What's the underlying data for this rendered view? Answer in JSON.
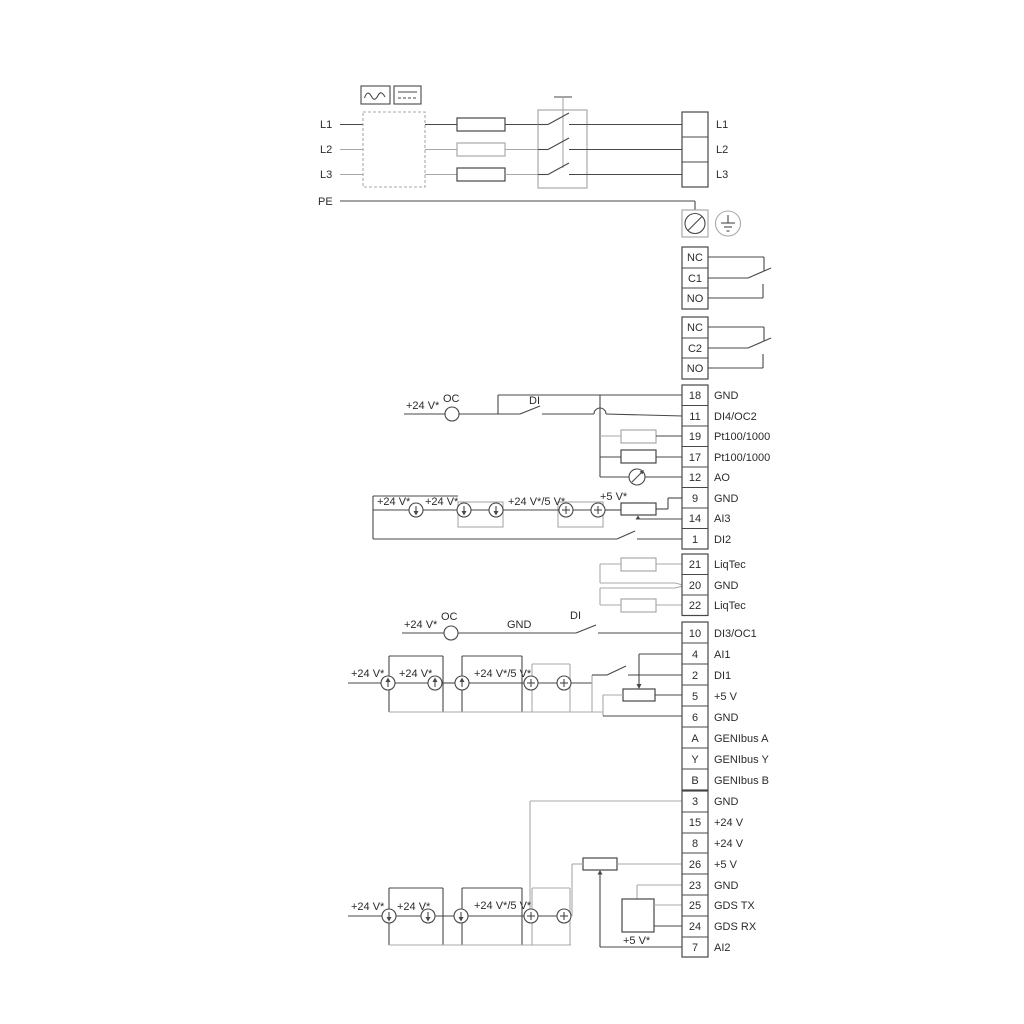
{
  "mains": {
    "input_labels": [
      "L1",
      "L2",
      "L3",
      "PE"
    ],
    "output_labels": [
      "L1",
      "L2",
      "L3"
    ]
  },
  "relay1": {
    "rows": [
      "NC",
      "C1",
      "NO"
    ]
  },
  "relay2": {
    "rows": [
      "NC",
      "C2",
      "NO"
    ]
  },
  "strip1": {
    "rows": [
      {
        "num": "18",
        "label": "GND"
      },
      {
        "num": "11",
        "label": "DI4/OC2"
      },
      {
        "num": "19",
        "label": "Pt100/1000"
      },
      {
        "num": "17",
        "label": "Pt100/1000"
      },
      {
        "num": "12",
        "label": "AO"
      },
      {
        "num": "9",
        "label": "GND"
      },
      {
        "num": "14",
        "label": "AI3"
      },
      {
        "num": "1",
        "label": "DI2"
      }
    ]
  },
  "strip2": {
    "rows": [
      {
        "num": "21",
        "label": "LiqTec"
      },
      {
        "num": "20",
        "label": "GND"
      },
      {
        "num": "22",
        "label": "LiqTec"
      }
    ]
  },
  "strip3": {
    "rows": [
      {
        "num": "10",
        "label": "DI3/OC1"
      },
      {
        "num": "4",
        "label": "AI1"
      },
      {
        "num": "2",
        "label": "DI1"
      },
      {
        "num": "5",
        "label": "+5 V"
      },
      {
        "num": "6",
        "label": "GND"
      },
      {
        "num": "A",
        "label": "GENIbus A"
      },
      {
        "num": "Y",
        "label": "GENIbus Y"
      },
      {
        "num": "B",
        "label": "GENIbus B"
      }
    ]
  },
  "strip4": {
    "rows": [
      {
        "num": "3",
        "label": "GND"
      },
      {
        "num": "15",
        "label": "+24 V"
      },
      {
        "num": "8",
        "label": "+24 V"
      },
      {
        "num": "26",
        "label": "+5 V"
      },
      {
        "num": "23",
        "label": "GND"
      },
      {
        "num": "25",
        "label": "GDS TX"
      },
      {
        "num": "24",
        "label": "GDS RX"
      },
      {
        "num": "7",
        "label": "AI2"
      }
    ]
  },
  "ann": {
    "v24": "+24 V*",
    "v24_5": "+24 V*/5 V*",
    "v5": "+5 V*",
    "oc": "OC",
    "di": "DI",
    "gnd": "GND"
  },
  "colors": {
    "line_dark": "#474747",
    "line_gray": "#a9a9a9",
    "text": "#2b2b2b"
  }
}
